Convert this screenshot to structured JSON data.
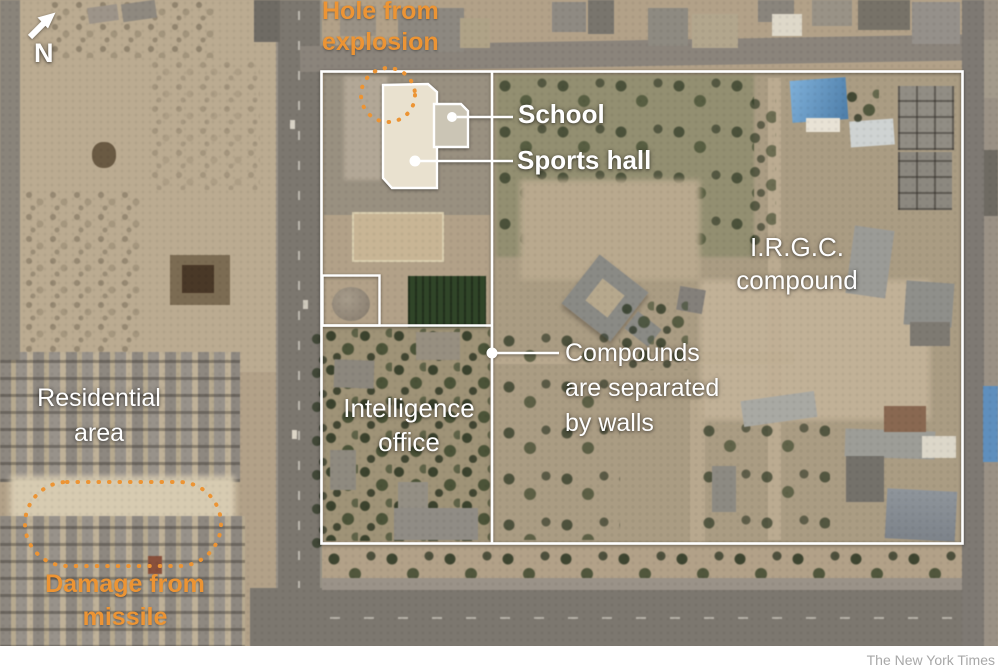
{
  "figure": {
    "credit": "The New York Times",
    "compass": {
      "label": "N"
    },
    "colors": {
      "annotation_orange": "#EC9434",
      "annotation_white": "#FFFFFF",
      "credit_gray": "#A8A8A8"
    },
    "labels": {
      "hole_from_explosion": {
        "line1": "Hole from",
        "line2": "explosion"
      },
      "school": {
        "text": "School"
      },
      "sports_hall": {
        "text": "Sports hall"
      },
      "irgc_compound": {
        "line1": "I.R.G.C.",
        "line2": "compound"
      },
      "compounds_separated": {
        "line1": "Compounds",
        "line2": "are separated",
        "line3": "by walls"
      },
      "intelligence_office": {
        "line1": "Intelligence",
        "line2": "office"
      },
      "residential_area": {
        "line1": "Residential",
        "line2": "area"
      },
      "damage_from_missile": {
        "line1": "Damage from",
        "line2": "missile"
      }
    }
  }
}
